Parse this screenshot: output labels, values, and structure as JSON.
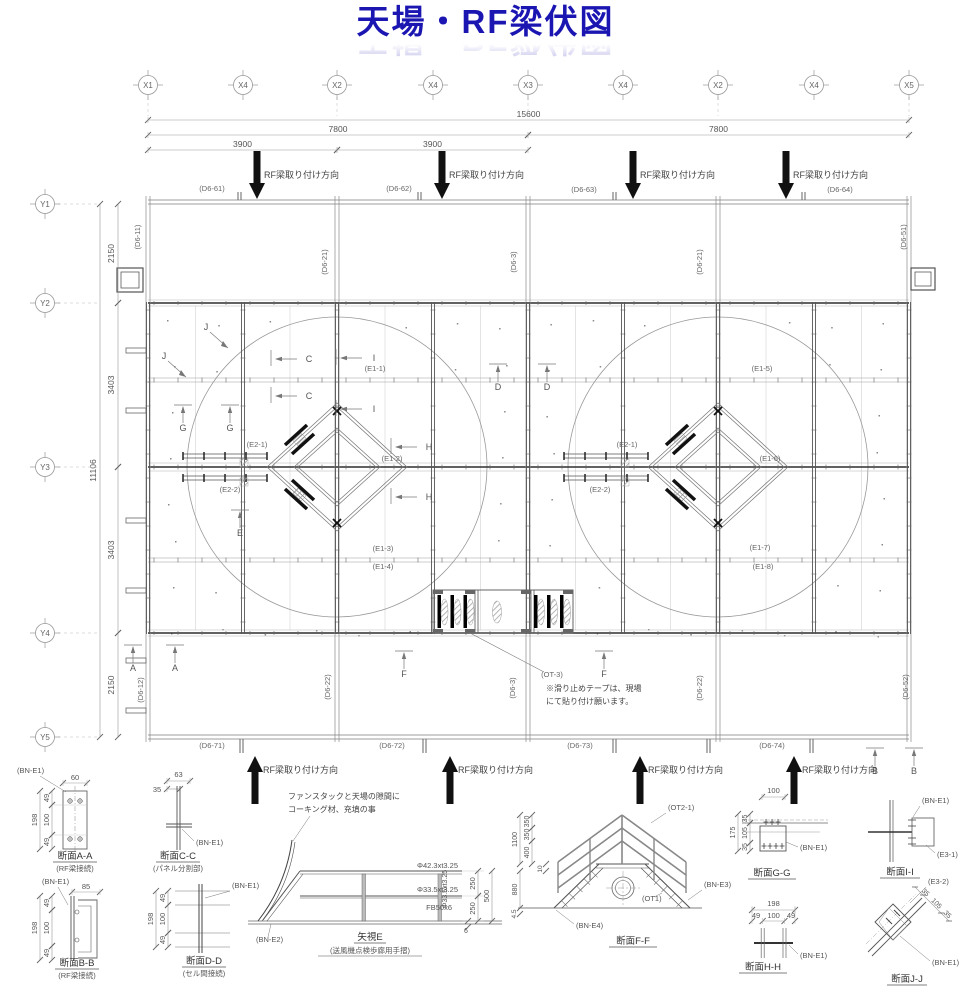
{
  "title": "天場・RF梁伏図",
  "colors": {
    "title": "#1b16b2",
    "line": "#7d7d7d",
    "dark": "#2f2f2f",
    "dim_text": "#555555"
  },
  "axes": {
    "x": [
      {
        "label": "X1",
        "x": 148
      },
      {
        "label": "X4",
        "x": 243
      },
      {
        "label": "X2",
        "x": 337
      },
      {
        "label": "X4",
        "x": 433
      },
      {
        "label": "X3",
        "x": 528
      },
      {
        "label": "X4",
        "x": 623
      },
      {
        "label": "X2",
        "x": 718
      },
      {
        "label": "X4",
        "x": 814
      },
      {
        "label": "X5",
        "x": 909
      }
    ],
    "y": [
      {
        "label": "Y1",
        "y": 204
      },
      {
        "label": "Y2",
        "y": 303
      },
      {
        "label": "Y3",
        "y": 467
      },
      {
        "label": "Y4",
        "y": 633
      },
      {
        "label": "Y5",
        "y": 737
      }
    ]
  },
  "top_dims": [
    {
      "text": "15600",
      "x1": 148,
      "x2": 909,
      "y": 120
    },
    {
      "text": "7800",
      "x1": 148,
      "x2": 528,
      "y": 135
    },
    {
      "text": "7800",
      "x1": 528,
      "x2": 909,
      "y": 135
    },
    {
      "text": "3900",
      "x1": 148,
      "x2": 337,
      "y": 150
    },
    {
      "text": "3900",
      "x1": 337,
      "x2": 528,
      "y": 150
    }
  ],
  "left_dims": [
    {
      "text": "2150",
      "y1": 204,
      "y2": 303,
      "x": 118
    },
    {
      "text": "3403",
      "y1": 303,
      "y2": 467,
      "x": 118
    },
    {
      "text": "3403",
      "y1": 467,
      "y2": 633,
      "x": 118
    },
    {
      "text": "2150",
      "y1": 633,
      "y2": 737,
      "x": 118
    },
    {
      "text": "11106",
      "y1": 204,
      "y2": 737,
      "x": 100
    }
  ],
  "install_direction_label": "RF梁取り付け方向",
  "top_arrows": [
    257,
    442,
    633,
    786
  ],
  "bottom_arrows": [
    255,
    450,
    640,
    794
  ],
  "beam_labels": [
    {
      "t": "(D6-61)",
      "x": 212,
      "y": 191
    },
    {
      "t": "(D6-62)",
      "x": 399,
      "y": 191
    },
    {
      "t": "(D6-63)",
      "x": 584,
      "y": 192
    },
    {
      "t": "(D6-64)",
      "x": 840,
      "y": 192
    },
    {
      "t": "(D6-11)",
      "x": 140,
      "y": 237,
      "rot": true
    },
    {
      "t": "(D6-51)",
      "x": 906,
      "y": 237,
      "rot": true
    },
    {
      "t": "(D6-21)",
      "x": 327,
      "y": 262,
      "rot": true
    },
    {
      "t": "(D6-3)",
      "x": 516,
      "y": 262,
      "rot": true
    },
    {
      "t": "(D6-21)",
      "x": 702,
      "y": 262,
      "rot": true
    },
    {
      "t": "(D6-12)",
      "x": 143,
      "y": 690,
      "rot": true
    },
    {
      "t": "(D6-22)",
      "x": 330,
      "y": 687,
      "rot": true
    },
    {
      "t": "(D6-3)",
      "x": 515,
      "y": 688,
      "rot": true
    },
    {
      "t": "(D6-22)",
      "x": 702,
      "y": 688,
      "rot": true
    },
    {
      "t": "(D6-52)",
      "x": 908,
      "y": 687,
      "rot": true
    },
    {
      "t": "(D6-71)",
      "x": 212,
      "y": 748
    },
    {
      "t": "(D6-72)",
      "x": 392,
      "y": 748
    },
    {
      "t": "(D6-73)",
      "x": 580,
      "y": 748
    },
    {
      "t": "(D6-74)",
      "x": 772,
      "y": 748
    },
    {
      "t": "(E1-1)",
      "x": 375,
      "y": 371
    },
    {
      "t": "(E1-2)",
      "x": 392,
      "y": 461
    },
    {
      "t": "(E1-3)",
      "x": 383,
      "y": 551
    },
    {
      "t": "(E1-4)",
      "x": 383,
      "y": 569
    },
    {
      "t": "(E1-5)",
      "x": 762,
      "y": 371
    },
    {
      "t": "(E1-6)",
      "x": 770,
      "y": 461
    },
    {
      "t": "(E1-7)",
      "x": 760,
      "y": 550
    },
    {
      "t": "(E1-8)",
      "x": 763,
      "y": 569
    },
    {
      "t": "(E2-1)",
      "x": 257,
      "y": 447
    },
    {
      "t": "(E2-2)",
      "x": 230,
      "y": 492
    },
    {
      "t": "(E2-1)",
      "x": 627,
      "y": 447
    },
    {
      "t": "(E2-2)",
      "x": 600,
      "y": 492
    },
    {
      "t": "(OT-3)",
      "x": 552,
      "y": 677
    }
  ],
  "callouts": [
    {
      "t": "J",
      "x": 206,
      "y": 330,
      "dir": "diag"
    },
    {
      "t": "J",
      "x": 164,
      "y": 359,
      "dir": "diag"
    },
    {
      "t": "C",
      "x": 309,
      "y": 362,
      "dir": "left"
    },
    {
      "t": "C",
      "x": 309,
      "y": 399,
      "dir": "left"
    },
    {
      "t": "I",
      "x": 374,
      "y": 361,
      "dir": "left"
    },
    {
      "t": "I",
      "x": 374,
      "y": 412,
      "dir": "left"
    },
    {
      "t": "G",
      "x": 183,
      "y": 431,
      "dir": "up"
    },
    {
      "t": "G",
      "x": 230,
      "y": 431,
      "dir": "up"
    },
    {
      "t": "D",
      "x": 498,
      "y": 390,
      "dir": "up"
    },
    {
      "t": "D",
      "x": 547,
      "y": 390,
      "dir": "up"
    },
    {
      "t": "H",
      "x": 429,
      "y": 450,
      "dir": "left"
    },
    {
      "t": "H",
      "x": 429,
      "y": 500,
      "dir": "left"
    },
    {
      "t": "E",
      "x": 240,
      "y": 536,
      "dir": "up"
    },
    {
      "t": "A",
      "x": 133,
      "y": 671,
      "dir": "up"
    },
    {
      "t": "A",
      "x": 175,
      "y": 671,
      "dir": "up"
    },
    {
      "t": "F",
      "x": 404,
      "y": 677,
      "dir": "up"
    },
    {
      "t": "F",
      "x": 604,
      "y": 677,
      "dir": "up"
    },
    {
      "t": "B",
      "x": 875,
      "y": 774,
      "dir": "up"
    },
    {
      "t": "B",
      "x": 914,
      "y": 774,
      "dir": "up"
    }
  ],
  "slip_note": [
    "※滑り止めテープは、現場",
    "にて貼り付け願います。"
  ],
  "caulk_note": [
    "ファンスタックと天場の隙間に",
    "コーキング材、充填の事"
  ],
  "sections": {
    "aa": {
      "title": "断面A-A",
      "sub": "(RF梁接続)",
      "bn": "(BN-E1)",
      "top": "60",
      "outer": "198",
      "chain": [
        "49",
        "100",
        "49"
      ]
    },
    "cc": {
      "title": "断面C-C",
      "sub": "(パネル分割部)",
      "bn": "(BN-E1)",
      "top": "63",
      "sub_dim": "35"
    },
    "bb": {
      "title": "断面B-B",
      "sub": "(RF梁接続)",
      "bn": "(BN-E1)",
      "top": "85",
      "outer": "198",
      "chain": [
        "49",
        "100",
        "49"
      ]
    },
    "dd": {
      "title": "断面D-D",
      "sub": "(セル間接続)",
      "bn": "(BN-E1)",
      "outer": "198",
      "chain": [
        "49",
        "100",
        "49"
      ]
    },
    "e": {
      "title": "矢視E",
      "sub": "(送風機点検歩廊用手摺)",
      "bn": "(BN-E2)",
      "rail_top": "Φ42.3xt3.25",
      "rail_mid": "Φ33.5xt3.25",
      "rail_bot": "FB50x6",
      "post": "Φ33.5xt3.25",
      "chain": [
        "250",
        "250"
      ],
      "outer": "500",
      "plate": "6"
    },
    "ff": {
      "title": "断面F-F",
      "ot2": "(OT2-1)",
      "bn3": "(BN-E3)",
      "ot1": "(OT1)",
      "bn4": "(BN-E4)",
      "chain": [
        "350",
        "350",
        "400"
      ],
      "outer": "1100",
      "plate": "10",
      "leg": "880",
      "base": "4.5"
    },
    "gg": {
      "title": "断面G-G",
      "bn": "(BN-E1)",
      "top": "100",
      "chain": [
        "35",
        "105",
        "35"
      ],
      "outer": "175"
    },
    "ii": {
      "title": "断面I-I",
      "bn": "(BN-E1)",
      "e3": "(E3-1)"
    },
    "hh": {
      "title": "断面H-H",
      "bn": "(BN-E1)",
      "top": "198",
      "chain": [
        "49",
        "100",
        "49"
      ]
    },
    "jj": {
      "title": "断面J-J",
      "bn": "(BN-E1)",
      "e3": "(E3-2)",
      "chain": [
        "35",
        "105",
        "35"
      ]
    }
  }
}
